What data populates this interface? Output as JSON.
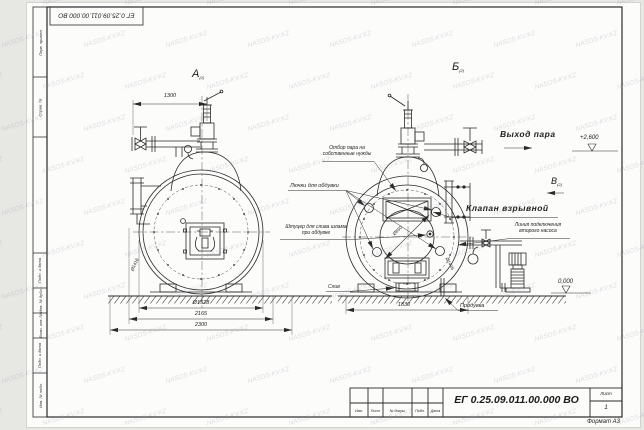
{
  "doc": {
    "number": "ЕГ 0.25.09.011.00.000  ВО",
    "stamp_top": "ЕГ 0.25.09.011.00.000  ВО",
    "format_note": "Формат А3",
    "sheet_label": "Лист",
    "sheet_value": "1",
    "revision_columns": [
      "Изм.",
      "Лист",
      "№ докум.",
      "Подп.",
      "Дата"
    ]
  },
  "margin_fields": [
    "Перв. примен.",
    "Справ. №",
    "Подп. и дата",
    "Инв. № дубл.",
    "Взам. инв. №",
    "Подп. и дата",
    "Инв. № подл."
  ],
  "views": {
    "a": {
      "label": "А",
      "note": "(2)"
    },
    "b": {
      "label": "Б",
      "note": "(2)"
    },
    "v": {
      "label": "В",
      "note": "(2)"
    }
  },
  "labels": {
    "steam_out": "Выход пара",
    "explosion_valve": "Клапан взрывной",
    "second_pump_line_1": "Линия подключения",
    "second_pump_line_2": "второго насоса",
    "steam_takeoff_1": "Отбор пара на",
    "steam_takeoff_2": "собственные нужды",
    "hatches": "Лючки для обдувки",
    "sludge_1": "Штуцер для слива шлама",
    "sludge_2": "при обдувке",
    "drain": "Слив",
    "blowdown": "Продувка"
  },
  "dimensions": {
    "top_width": "1300",
    "diameter": "Ø1528",
    "width_mid": "2165",
    "width_overall": "2300",
    "rear_width": "1830",
    "manhole": "Ø650",
    "plate_left": "Ø1416",
    "plate_right": "Ø1416"
  },
  "elevations": {
    "steam": "+2,600",
    "ground": "0,000"
  },
  "watermark": {
    "text": "NASOS-KV.KZ"
  },
  "colors": {
    "line": "#2a2a2a",
    "paper": "#fcfcfa",
    "background": "#e7e7e4",
    "watermark": "#808ca0"
  }
}
